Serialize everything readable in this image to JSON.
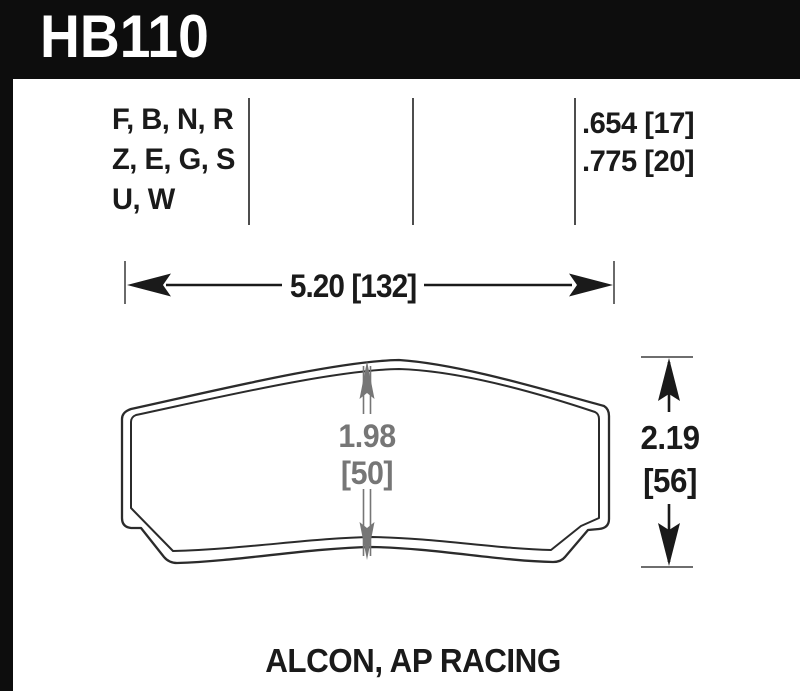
{
  "header": {
    "part_number": "HB110"
  },
  "spec_row": {
    "compounds": [
      "F, B, N, R",
      "Z, E, G, S",
      "U, W"
    ],
    "pad_thickness": [
      ".654 [17]",
      ".775 [20]"
    ]
  },
  "dimensions": {
    "width": "5.20 [132]",
    "height": [
      "2.19",
      "[56]"
    ],
    "center_height": [
      "1.98",
      "[50]"
    ]
  },
  "caliper": "ALCON, AP RACING",
  "colors": {
    "header_bg": "#0d0d0d",
    "ink": "#1a1a1a",
    "dim_gray": "#767676",
    "line_gray": "#4d4d4d"
  }
}
